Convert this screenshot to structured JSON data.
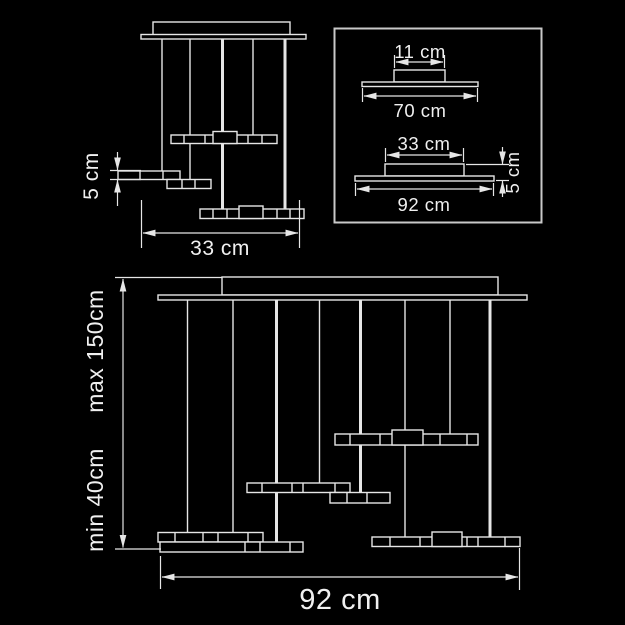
{
  "colors": {
    "background": "#000000",
    "line": "#e6e6e6",
    "box_border": "#c9c9c9",
    "text": "#f0f0f0"
  },
  "small_view": {
    "bar_height_label": "5 cm",
    "width_label": "33 cm"
  },
  "detail_box": {
    "canopy_width_label": "11 cm",
    "canopy_plate_width_label": "70 cm",
    "base_top_width_label": "33 cm",
    "base_plate_width_label": "92 cm",
    "base_height_label": "5 cm"
  },
  "large_view": {
    "min_height_label": "min 40cm",
    "max_height_label": "max 150cm",
    "width_label": "92 cm"
  }
}
